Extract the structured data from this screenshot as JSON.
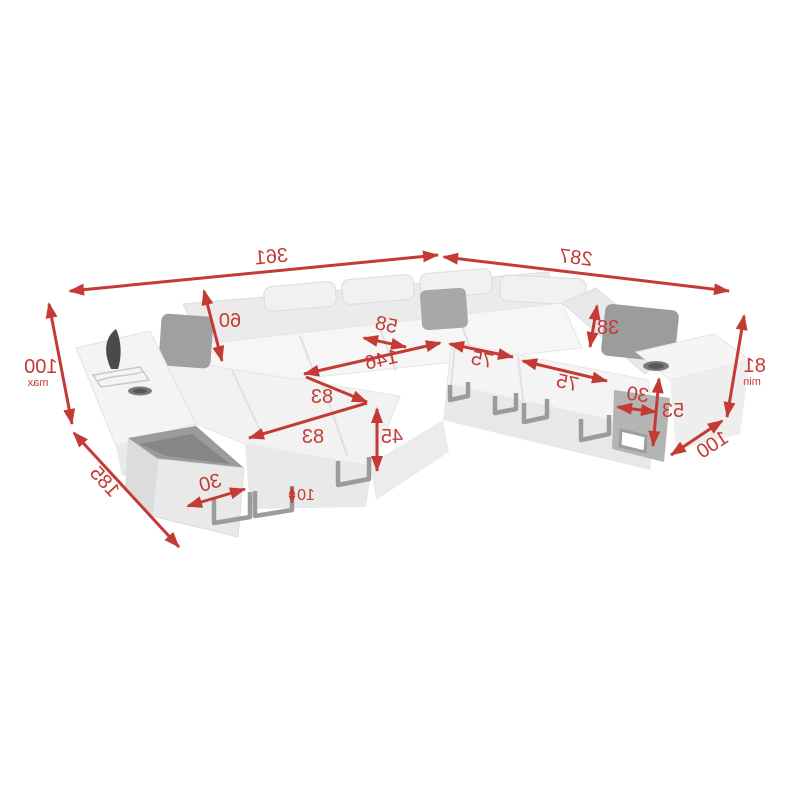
{
  "diagram": {
    "accent_color": "#c43a34",
    "sofa_body_color": "#f2f2f2",
    "pillow_color": "#a0a0a0",
    "text_mirrored": true,
    "dimensions": {
      "total_width": {
        "value": "361"
      },
      "total_depth_right": {
        "value": "287"
      },
      "height_left": {
        "value": "100",
        "note": "max"
      },
      "chaise_depth": {
        "value": "185"
      },
      "backrest_height": {
        "value": "60"
      },
      "corner_seat_width": {
        "value": "58"
      },
      "sleeping_length": {
        "value": "146"
      },
      "sleeping_width_a": {
        "value": "83"
      },
      "sleeping_width_b": {
        "value": "83"
      },
      "seat_height": {
        "value": "45"
      },
      "storage_depth": {
        "value": "30"
      },
      "leg_height": {
        "value": "10"
      },
      "headrest_height": {
        "value": "38"
      },
      "seat_width_a": {
        "value": "75"
      },
      "seat_width_b": {
        "value": "75"
      },
      "armrest_width": {
        "value": "30"
      },
      "armrest_height": {
        "value": "53"
      },
      "height_right": {
        "value": "81",
        "note": "min"
      },
      "arm_depth_right": {
        "value": "100"
      }
    }
  }
}
